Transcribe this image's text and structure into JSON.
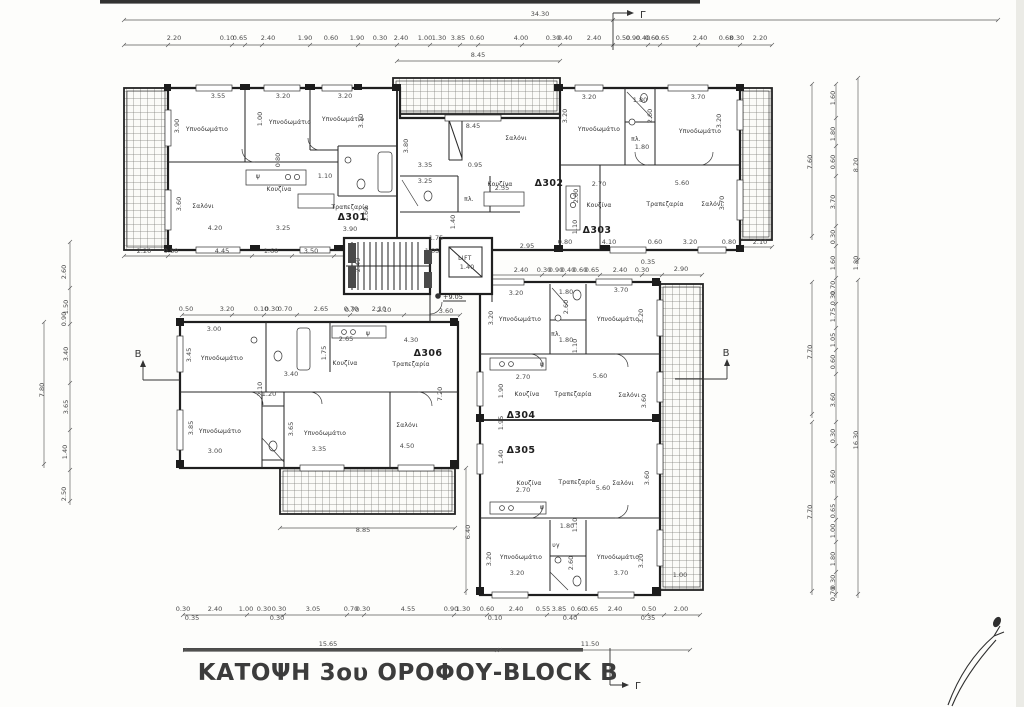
{
  "plan": {
    "title": "ΚΑΤΟΨΗ 3ου ΟΡΟΦΟΥ-BLOCK B",
    "overall_width": "34.30",
    "level_marker": "+9.05",
    "lift_label": "LIFT",
    "section_markers": {
      "top": "Γ",
      "bottom": "Γ",
      "left": "B",
      "right": "B"
    },
    "apartments": [
      {
        "id": "Δ301"
      },
      {
        "id": "Δ302"
      },
      {
        "id": "Δ303"
      },
      {
        "id": "Δ304"
      },
      {
        "id": "Δ305"
      },
      {
        "id": "Δ306"
      }
    ],
    "room_labels": [
      {
        "t": "Υπνοδωμάτιο",
        "x": 207,
        "y": 131
      },
      {
        "t": "Υπνοδωμάτιο",
        "x": 290,
        "y": 124
      },
      {
        "t": "Υπνοδωμάτιο",
        "x": 343,
        "y": 121
      },
      {
        "t": "Σαλόνι",
        "x": 203,
        "y": 208
      },
      {
        "t": "Κουζίνα",
        "x": 279,
        "y": 191
      },
      {
        "t": "Τραπεζαρία",
        "x": 350,
        "y": 209
      },
      {
        "t": "ψ",
        "x": 258,
        "y": 178
      },
      {
        "t": "Σαλόνι",
        "x": 516,
        "y": 140
      },
      {
        "t": "Κουζίνα",
        "x": 500,
        "y": 186
      },
      {
        "t": "πλ.",
        "x": 469,
        "y": 201
      },
      {
        "t": "Υπνοδωμάτιο",
        "x": 599,
        "y": 131
      },
      {
        "t": "Υπνοδωμάτιο",
        "x": 700,
        "y": 133
      },
      {
        "t": "πλ.",
        "x": 636,
        "y": 141
      },
      {
        "t": "Κουζίνα",
        "x": 599,
        "y": 207
      },
      {
        "t": "Τραπεζαρία",
        "x": 665,
        "y": 206
      },
      {
        "t": "Σαλόνι",
        "x": 712,
        "y": 206
      },
      {
        "t": "Υπνοδωμάτιο",
        "x": 222,
        "y": 360
      },
      {
        "t": "Κουζίνα",
        "x": 345,
        "y": 365
      },
      {
        "t": "Τραπεζαρία",
        "x": 411,
        "y": 366
      },
      {
        "t": "ψ",
        "x": 368,
        "y": 335
      },
      {
        "t": "Υπνοδωμάτιο",
        "x": 220,
        "y": 433
      },
      {
        "t": "Υπνοδωμάτιο",
        "x": 325,
        "y": 435
      },
      {
        "t": "Σαλόνι",
        "x": 407,
        "y": 427
      },
      {
        "t": "Υπνοδωμάτιο",
        "x": 520,
        "y": 321
      },
      {
        "t": "Υπνοδωμάτιο",
        "x": 618,
        "y": 321
      },
      {
        "t": "πλ.",
        "x": 556,
        "y": 336
      },
      {
        "t": "ψ",
        "x": 542,
        "y": 366
      },
      {
        "t": "Κουζίνα",
        "x": 527,
        "y": 396
      },
      {
        "t": "Τραπεζαρία",
        "x": 573,
        "y": 396
      },
      {
        "t": "Σαλόνι",
        "x": 629,
        "y": 397
      },
      {
        "t": "Κουζίνα",
        "x": 529,
        "y": 485
      },
      {
        "t": "Τραπεζαρία",
        "x": 577,
        "y": 484
      },
      {
        "t": "Σαλόνι",
        "x": 623,
        "y": 485
      },
      {
        "t": "ψ",
        "x": 542,
        "y": 509
      },
      {
        "t": "υγ",
        "x": 556,
        "y": 547
      },
      {
        "t": "Υπνοδωμάτιο",
        "x": 521,
        "y": 559
      },
      {
        "t": "Υπνοδωμάτιο",
        "x": 618,
        "y": 559
      }
    ],
    "dimension_labels": [
      {
        "t": "34.30",
        "x": 540,
        "y": 16
      },
      {
        "t": "2.20",
        "x": 174,
        "y": 40
      },
      {
        "t": "0.10",
        "x": 227,
        "y": 40
      },
      {
        "t": "0.65",
        "x": 240,
        "y": 40
      },
      {
        "t": "2.40",
        "x": 268,
        "y": 40
      },
      {
        "t": "1.90",
        "x": 305,
        "y": 40
      },
      {
        "t": "0.60",
        "x": 331,
        "y": 40
      },
      {
        "t": "1.90",
        "x": 357,
        "y": 40
      },
      {
        "t": "0.30",
        "x": 380,
        "y": 40
      },
      {
        "t": "2.40",
        "x": 401,
        "y": 40
      },
      {
        "t": "1.00",
        "x": 425,
        "y": 40
      },
      {
        "t": "1.30",
        "x": 439,
        "y": 40
      },
      {
        "t": "3.85",
        "x": 458,
        "y": 40
      },
      {
        "t": "0.60",
        "x": 477,
        "y": 40
      },
      {
        "t": "4.00",
        "x": 521,
        "y": 40
      },
      {
        "t": "0.30",
        "x": 553,
        "y": 40
      },
      {
        "t": "0.40",
        "x": 565,
        "y": 40
      },
      {
        "t": "2.40",
        "x": 594,
        "y": 40
      },
      {
        "t": "0.50",
        "x": 623,
        "y": 40
      },
      {
        "t": "0.90",
        "x": 633,
        "y": 40
      },
      {
        "t": "0.40",
        "x": 643,
        "y": 40
      },
      {
        "t": "0.60",
        "x": 652,
        "y": 40
      },
      {
        "t": "0.65",
        "x": 662,
        "y": 40
      },
      {
        "t": "2.40",
        "x": 700,
        "y": 40
      },
      {
        "t": "0.68",
        "x": 726,
        "y": 40
      },
      {
        "t": "0.30",
        "x": 737,
        "y": 40
      },
      {
        "t": "2.20",
        "x": 760,
        "y": 40
      },
      {
        "t": "8.45",
        "x": 478,
        "y": 57
      },
      {
        "t": "2.20",
        "x": 144,
        "y": 253
      },
      {
        "t": "0.80",
        "x": 171,
        "y": 253
      },
      {
        "t": "4.45",
        "x": 222,
        "y": 253
      },
      {
        "t": "1.60",
        "x": 271,
        "y": 253
      },
      {
        "t": "3.50",
        "x": 311,
        "y": 253
      },
      {
        "t": "0.80",
        "x": 565,
        "y": 244
      },
      {
        "t": "4.10",
        "x": 609,
        "y": 244
      },
      {
        "t": "0.60",
        "x": 655,
        "y": 244
      },
      {
        "t": "3.20",
        "x": 690,
        "y": 244
      },
      {
        "t": "0.80",
        "x": 729,
        "y": 244
      },
      {
        "t": "2.10",
        "x": 760,
        "y": 244
      },
      {
        "t": "1.75",
        "x": 436,
        "y": 240
      },
      {
        "t": "1.05",
        "x": 432,
        "y": 253
      },
      {
        "t": "1.40",
        "x": 467,
        "y": 269
      },
      {
        "t": "2.40",
        "x": 360,
        "y": 265,
        "r": 1
      },
      {
        "t": "2.95",
        "x": 527,
        "y": 248
      },
      {
        "t": "0.70",
        "x": 352,
        "y": 312
      },
      {
        "t": "2.10",
        "x": 384,
        "y": 312
      },
      {
        "t": "3.60",
        "x": 446,
        "y": 313
      },
      {
        "t": "2.65",
        "x": 346,
        "y": 341
      },
      {
        "t": "2.40",
        "x": 521,
        "y": 272
      },
      {
        "t": "0.30",
        "x": 544,
        "y": 272
      },
      {
        "t": "0.90",
        "x": 556,
        "y": 272
      },
      {
        "t": "0.40",
        "x": 568,
        "y": 272
      },
      {
        "t": "0.60",
        "x": 580,
        "y": 272
      },
      {
        "t": "0.65",
        "x": 592,
        "y": 272
      },
      {
        "t": "2.40",
        "x": 620,
        "y": 272
      },
      {
        "t": "0.30",
        "x": 642,
        "y": 272
      },
      {
        "t": "0.35",
        "x": 648,
        "y": 264
      },
      {
        "t": "2.90",
        "x": 681,
        "y": 271
      },
      {
        "t": "0.50",
        "x": 186,
        "y": 311
      },
      {
        "t": "3.20",
        "x": 227,
        "y": 311
      },
      {
        "t": "0.10",
        "x": 261,
        "y": 311
      },
      {
        "t": "0.30",
        "x": 272,
        "y": 311
      },
      {
        "t": "0.70",
        "x": 285,
        "y": 311
      },
      {
        "t": "2.65",
        "x": 321,
        "y": 311
      },
      {
        "t": "0.70",
        "x": 351,
        "y": 311
      },
      {
        "t": "2.10",
        "x": 379,
        "y": 311
      },
      {
        "t": "3.55",
        "x": 218,
        "y": 98
      },
      {
        "t": "3.20",
        "x": 283,
        "y": 98
      },
      {
        "t": "3.20",
        "x": 345,
        "y": 98
      },
      {
        "t": "3.90",
        "x": 179,
        "y": 126,
        "r": 1
      },
      {
        "t": "1.00",
        "x": 262,
        "y": 119,
        "r": 1
      },
      {
        "t": "3.10",
        "x": 363,
        "y": 121,
        "r": 1
      },
      {
        "t": "0.80",
        "x": 280,
        "y": 160,
        "r": 1
      },
      {
        "t": "1.10",
        "x": 325,
        "y": 178
      },
      {
        "t": "3.60",
        "x": 181,
        "y": 204,
        "r": 1
      },
      {
        "t": "4.20",
        "x": 215,
        "y": 230
      },
      {
        "t": "3.25",
        "x": 283,
        "y": 230
      },
      {
        "t": "3.90",
        "x": 350,
        "y": 231
      },
      {
        "t": "2.60",
        "x": 368,
        "y": 214,
        "r": 1
      },
      {
        "t": "8.45",
        "x": 473,
        "y": 128
      },
      {
        "t": "3.80",
        "x": 408,
        "y": 146,
        "r": 1
      },
      {
        "t": "3.35",
        "x": 425,
        "y": 167
      },
      {
        "t": "0.95",
        "x": 475,
        "y": 167
      },
      {
        "t": "3.25",
        "x": 425,
        "y": 183
      },
      {
        "t": "2.35",
        "x": 502,
        "y": 190
      },
      {
        "t": "1.40",
        "x": 455,
        "y": 222,
        "r": 1
      },
      {
        "t": "3.20",
        "x": 589,
        "y": 99
      },
      {
        "t": "1.80",
        "x": 640,
        "y": 102
      },
      {
        "t": "3.70",
        "x": 698,
        "y": 99
      },
      {
        "t": "3.20",
        "x": 567,
        "y": 116,
        "r": 1
      },
      {
        "t": "2.60",
        "x": 652,
        "y": 116,
        "r": 1
      },
      {
        "t": "3.20",
        "x": 721,
        "y": 121,
        "r": 1
      },
      {
        "t": "1.80",
        "x": 642,
        "y": 149
      },
      {
        "t": "2.70",
        "x": 599,
        "y": 186
      },
      {
        "t": "5.60",
        "x": 682,
        "y": 185
      },
      {
        "t": "2.00",
        "x": 578,
        "y": 196,
        "r": 1
      },
      {
        "t": "1.10",
        "x": 577,
        "y": 227,
        "r": 1
      },
      {
        "t": "3.70",
        "x": 724,
        "y": 203,
        "r": 1
      },
      {
        "t": "3.00",
        "x": 214,
        "y": 331
      },
      {
        "t": "3.45",
        "x": 191,
        "y": 355,
        "r": 1
      },
      {
        "t": "1.75",
        "x": 326,
        "y": 353,
        "r": 1
      },
      {
        "t": "4.30",
        "x": 411,
        "y": 342
      },
      {
        "t": "3.40",
        "x": 291,
        "y": 376
      },
      {
        "t": "2.10",
        "x": 262,
        "y": 389,
        "r": 1
      },
      {
        "t": "1.20",
        "x": 269,
        "y": 396
      },
      {
        "t": "3.85",
        "x": 193,
        "y": 428,
        "r": 1
      },
      {
        "t": "3.00",
        "x": 215,
        "y": 453
      },
      {
        "t": "3.65",
        "x": 293,
        "y": 429,
        "r": 1
      },
      {
        "t": "3.35",
        "x": 319,
        "y": 451
      },
      {
        "t": "4.50",
        "x": 407,
        "y": 448
      },
      {
        "t": "7.20",
        "x": 442,
        "y": 394,
        "r": 1
      },
      {
        "t": "3.20",
        "x": 516,
        "y": 295
      },
      {
        "t": "1.80",
        "x": 566,
        "y": 294
      },
      {
        "t": "3.70",
        "x": 621,
        "y": 292
      },
      {
        "t": "3.20",
        "x": 493,
        "y": 318,
        "r": 1
      },
      {
        "t": "2.60",
        "x": 568,
        "y": 307,
        "r": 1
      },
      {
        "t": "3.20",
        "x": 643,
        "y": 316,
        "r": 1
      },
      {
        "t": "1.80",
        "x": 566,
        "y": 342
      },
      {
        "t": "1.10",
        "x": 577,
        "y": 346,
        "r": 1
      },
      {
        "t": "2.70",
        "x": 523,
        "y": 379
      },
      {
        "t": "5.60",
        "x": 600,
        "y": 378
      },
      {
        "t": "1.90",
        "x": 503,
        "y": 391,
        "r": 1
      },
      {
        "t": "3.60",
        "x": 646,
        "y": 401,
        "r": 1
      },
      {
        "t": "1.95",
        "x": 503,
        "y": 423,
        "r": 1
      },
      {
        "t": "1.40",
        "x": 503,
        "y": 457,
        "r": 1
      },
      {
        "t": "2.70",
        "x": 523,
        "y": 492
      },
      {
        "t": "5.60",
        "x": 603,
        "y": 490
      },
      {
        "t": "3.60",
        "x": 649,
        "y": 478,
        "r": 1
      },
      {
        "t": "1.80",
        "x": 567,
        "y": 528
      },
      {
        "t": "1.10",
        "x": 577,
        "y": 525,
        "r": 1
      },
      {
        "t": "3.20",
        "x": 491,
        "y": 559,
        "r": 1
      },
      {
        "t": "3.20",
        "x": 517,
        "y": 575
      },
      {
        "t": "2.60",
        "x": 573,
        "y": 563,
        "r": 1
      },
      {
        "t": "3.70",
        "x": 621,
        "y": 575
      },
      {
        "t": "3.20",
        "x": 643,
        "y": 561,
        "r": 1
      },
      {
        "t": "1.00",
        "x": 680,
        "y": 577
      },
      {
        "t": "8.85",
        "x": 363,
        "y": 532
      },
      {
        "t": "6.40",
        "x": 470,
        "y": 532,
        "r": 1
      },
      {
        "t": "2.60",
        "x": 66,
        "y": 272,
        "r": 1
      },
      {
        "t": "1.50",
        "x": 68,
        "y": 307,
        "r": 1
      },
      {
        "t": "0.90",
        "x": 66,
        "y": 319,
        "r": 1
      },
      {
        "t": "3.40",
        "x": 68,
        "y": 354,
        "r": 1
      },
      {
        "t": "3.65",
        "x": 68,
        "y": 407,
        "r": 1
      },
      {
        "t": "1.40",
        "x": 67,
        "y": 452,
        "r": 1
      },
      {
        "t": "2.50",
        "x": 66,
        "y": 494,
        "r": 1
      },
      {
        "t": "7.80",
        "x": 44,
        "y": 390,
        "r": 1
      },
      {
        "t": "1.60",
        "x": 835,
        "y": 98,
        "r": 1
      },
      {
        "t": "1.80",
        "x": 835,
        "y": 134,
        "r": 1
      },
      {
        "t": "0.60",
        "x": 835,
        "y": 162,
        "r": 1
      },
      {
        "t": "3.70",
        "x": 835,
        "y": 202,
        "r": 1
      },
      {
        "t": "0.30",
        "x": 835,
        "y": 237,
        "r": 1
      },
      {
        "t": "1.60",
        "x": 835,
        "y": 263,
        "r": 1
      },
      {
        "t": "0.70",
        "x": 835,
        "y": 288,
        "r": 1
      },
      {
        "t": "0.30",
        "x": 835,
        "y": 298,
        "r": 1
      },
      {
        "t": "1.75",
        "x": 835,
        "y": 315,
        "r": 1
      },
      {
        "t": "1.05",
        "x": 835,
        "y": 340,
        "r": 1
      },
      {
        "t": "0.60",
        "x": 835,
        "y": 362,
        "r": 1
      },
      {
        "t": "3.60",
        "x": 835,
        "y": 400,
        "r": 1
      },
      {
        "t": "0.30",
        "x": 835,
        "y": 436,
        "r": 1
      },
      {
        "t": "3.60",
        "x": 835,
        "y": 477,
        "r": 1
      },
      {
        "t": "0.65",
        "x": 835,
        "y": 511,
        "r": 1
      },
      {
        "t": "1.00",
        "x": 835,
        "y": 531,
        "r": 1
      },
      {
        "t": "1.80",
        "x": 835,
        "y": 559,
        "r": 1
      },
      {
        "t": "0.30",
        "x": 835,
        "y": 582,
        "r": 1
      },
      {
        "t": "0.70",
        "x": 835,
        "y": 594,
        "r": 1
      },
      {
        "t": "7.60",
        "x": 812,
        "y": 162,
        "r": 1
      },
      {
        "t": "8.20",
        "x": 858,
        "y": 165,
        "r": 1
      },
      {
        "t": "1.80",
        "x": 858,
        "y": 263,
        "r": 1
      },
      {
        "t": "7.70",
        "x": 812,
        "y": 352,
        "r": 1
      },
      {
        "t": "7.70",
        "x": 812,
        "y": 512,
        "r": 1
      },
      {
        "t": "16.30",
        "x": 858,
        "y": 440,
        "r": 1
      },
      {
        "t": "0.30",
        "x": 183,
        "y": 611
      },
      {
        "t": "2.40",
        "x": 215,
        "y": 611
      },
      {
        "t": "1.00",
        "x": 246,
        "y": 611
      },
      {
        "t": "0.30",
        "x": 264,
        "y": 611
      },
      {
        "t": "0.30",
        "x": 279,
        "y": 611
      },
      {
        "t": "3.05",
        "x": 313,
        "y": 611
      },
      {
        "t": "0.70",
        "x": 351,
        "y": 611
      },
      {
        "t": "0.30",
        "x": 363,
        "y": 611
      },
      {
        "t": "4.55",
        "x": 408,
        "y": 611
      },
      {
        "t": "0.90",
        "x": 451,
        "y": 611
      },
      {
        "t": "1.30",
        "x": 463,
        "y": 611
      },
      {
        "t": "0.60",
        "x": 487,
        "y": 611
      },
      {
        "t": "2.40",
        "x": 516,
        "y": 611
      },
      {
        "t": "0.55",
        "x": 543,
        "y": 611
      },
      {
        "t": "3.85",
        "x": 559,
        "y": 611
      },
      {
        "t": "0.60",
        "x": 578,
        "y": 611
      },
      {
        "t": "0.65",
        "x": 591,
        "y": 611
      },
      {
        "t": "2.40",
        "x": 615,
        "y": 611
      },
      {
        "t": "0.50",
        "x": 649,
        "y": 611
      },
      {
        "t": "2.00",
        "x": 681,
        "y": 611
      },
      {
        "t": "0.35",
        "x": 192,
        "y": 620
      },
      {
        "t": "0.30",
        "x": 277,
        "y": 620
      },
      {
        "t": "0.10",
        "x": 495,
        "y": 620
      },
      {
        "t": "0.40",
        "x": 570,
        "y": 620
      },
      {
        "t": "0.35",
        "x": 648,
        "y": 620
      },
      {
        "t": "15.65",
        "x": 328,
        "y": 646
      },
      {
        "t": "11.50",
        "x": 590,
        "y": 646
      }
    ]
  }
}
